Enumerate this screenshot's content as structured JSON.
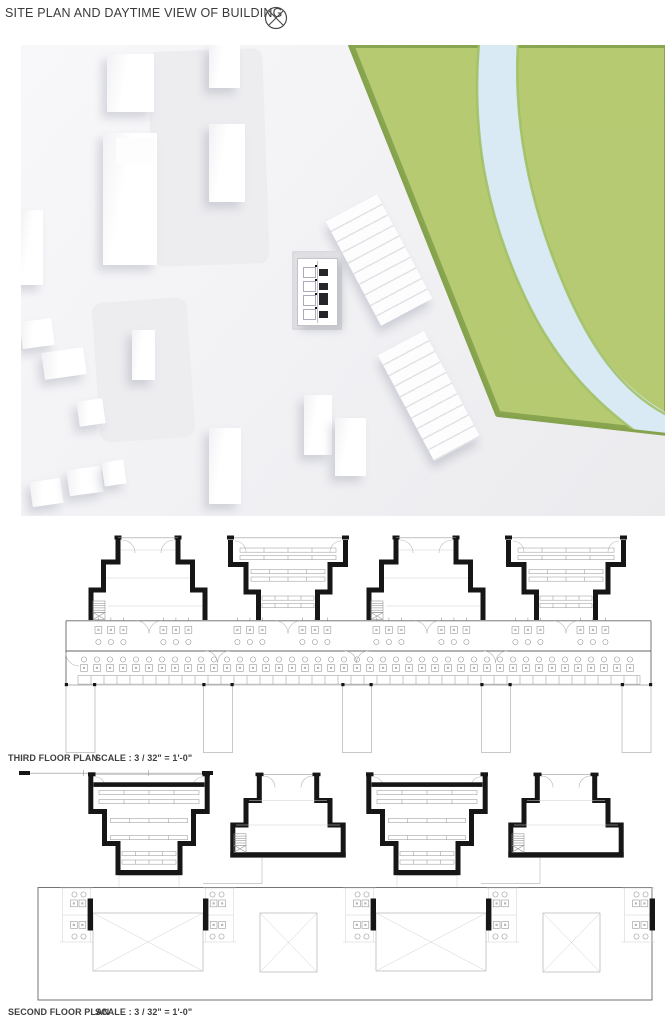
{
  "header": {
    "title": "SITE PLAN AND DAYTIME VIEW OF BUILDING"
  },
  "site_render": {
    "type": "aerial-daytime-3d-render",
    "features": [
      "white massing buildings",
      "subject building with dark skylights",
      "terraced stepped buildings",
      "riverside park",
      "river"
    ],
    "colors": {
      "ground": "#f1f1f4",
      "building": "#ffffff",
      "grass": "#b7cb72",
      "grass_edge": "#85a24c",
      "river": "#d9eaf5",
      "subject_windows": "#26262a"
    }
  },
  "plans": {
    "third": {
      "label": "THIRD FLOOR PLAN",
      "scale": "SCALE : 3 / 32\" = 1'-0\"",
      "unit_count": 4
    },
    "second": {
      "label": "SECOND FLOOR PLAN",
      "scale": "SCALE : 3 / 32\" = 1'-0\"",
      "unit_count": 4
    }
  },
  "plan_style": {
    "wall": "#161616",
    "line": "#8f8f8f",
    "faint": "#cfcfcf",
    "text": "#3e3e3e"
  }
}
